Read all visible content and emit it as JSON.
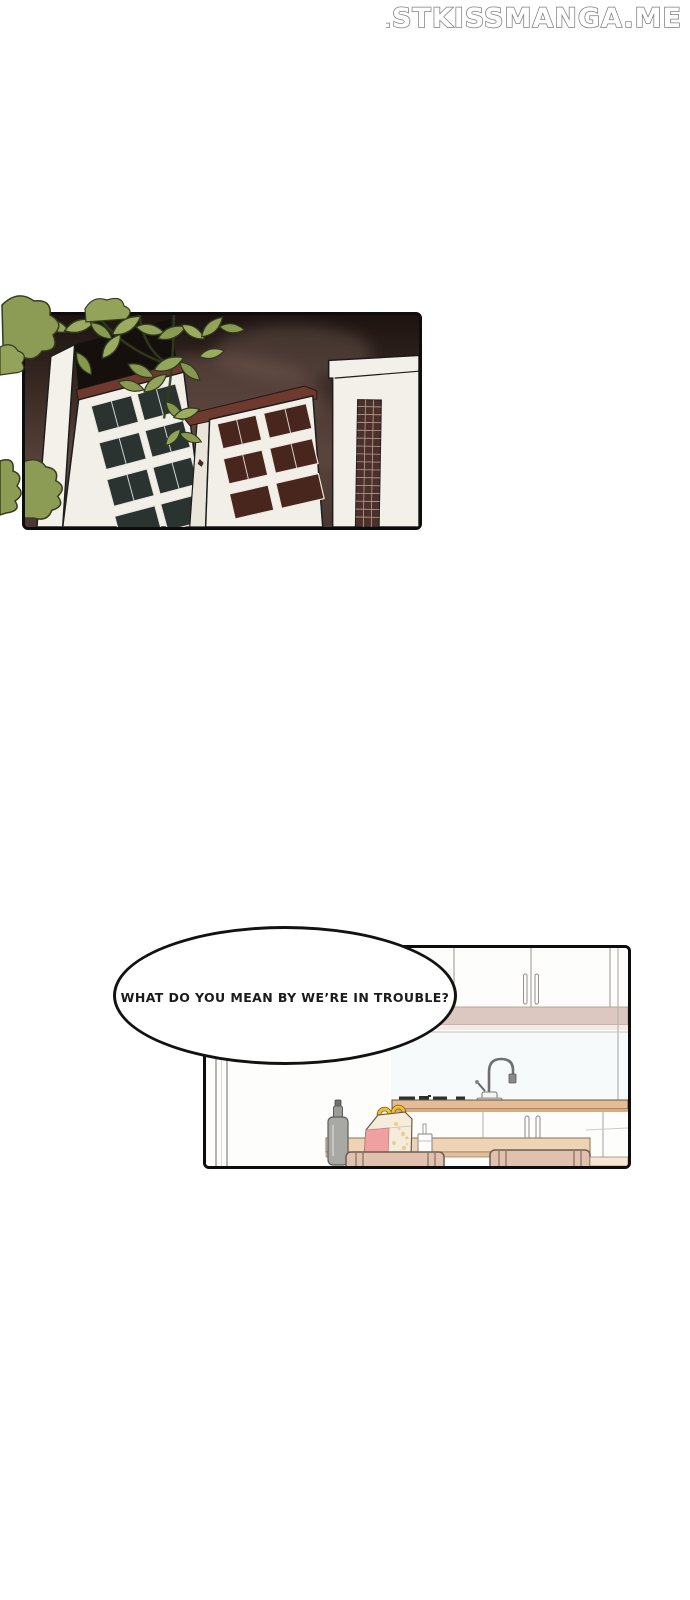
{
  "watermark": {
    "text": "1STKISSMANGA.ME"
  },
  "speech_bubble": {
    "text": "WHAT DO YOU MEAN BY WE’RE IN TROUBLE?"
  },
  "panels": {
    "city": {
      "description": "Low-angle view of white apartment towers against a dark smoky night sky, green leafy branches in the foreground"
    },
    "kitchen": {
      "description": "Kitchen with white upper cabinets, pink soffit shelf, gooseneck faucet on a tan counter, gray bottle, takeout box with golden arch handles, paper cup, and tan chairs at an island"
    }
  },
  "palette": {
    "page_background": "#ffffff",
    "panel_border": "#0d0d0d",
    "night_sky_dark": "#1c1310",
    "night_sky_light": "#55423a",
    "smoke": "#6b544a",
    "building_white": "#f2efe8",
    "roof_trim": "#6e3a30",
    "window_dark": "#2b3331",
    "window_maroon": "#48261e",
    "leaf_green": "#9cab60",
    "leaf_outline": "#333d1e",
    "soffit_pink": "#dcc8c0",
    "counter_tan": "#e5bc95",
    "chair_tan": "#e0c1ae",
    "box_pink": "#efa0a0",
    "arch_gold": "#f0c030"
  }
}
